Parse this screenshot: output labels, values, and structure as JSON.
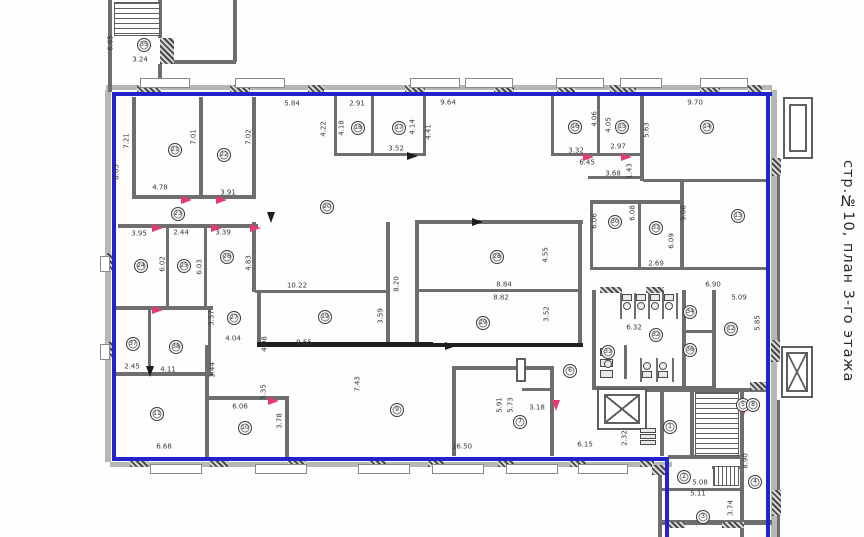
{
  "title": "стр.№10, план 3-го этажа",
  "colors": {
    "boundary": "#2323cd",
    "wall": "#6e6e6e",
    "dark_wall": "#1f1f1f",
    "door_red": "#e23a74",
    "label": "#3a3a3a"
  },
  "plan": {
    "bands": [
      [
        106,
        85,
        666,
        5
      ],
      [
        105,
        90,
        6,
        372
      ],
      [
        110,
        462,
        562,
        5
      ],
      [
        771,
        90,
        6,
        447
      ]
    ],
    "walls": [
      [
        108,
        0,
        4,
        92
      ],
      [
        158,
        0,
        4,
        38
      ],
      [
        158,
        64,
        4,
        24
      ],
      [
        233,
        0,
        4,
        62
      ],
      [
        174,
        60,
        62,
        4
      ],
      [
        132,
        97,
        4,
        100
      ],
      [
        199,
        97,
        4,
        100
      ],
      [
        252,
        97,
        4,
        100
      ],
      [
        132,
        195,
        124,
        4
      ],
      [
        334,
        95,
        3,
        60
      ],
      [
        371,
        95,
        3,
        60
      ],
      [
        423,
        95,
        3,
        60
      ],
      [
        334,
        153,
        92,
        3
      ],
      [
        551,
        95,
        3,
        60
      ],
      [
        597,
        95,
        3,
        60
      ],
      [
        640,
        95,
        4,
        86
      ],
      [
        551,
        153,
        92,
        3
      ],
      [
        588,
        176,
        54,
        3
      ],
      [
        590,
        200,
        92,
        4
      ],
      [
        643,
        179,
        126,
        3
      ],
      [
        680,
        182,
        4,
        88
      ],
      [
        590,
        203,
        3,
        66
      ],
      [
        638,
        203,
        3,
        66
      ],
      [
        590,
        267,
        180,
        3
      ],
      [
        118,
        224,
        140,
        4
      ],
      [
        166,
        228,
        3,
        80
      ],
      [
        204,
        228,
        3,
        80
      ],
      [
        252,
        222,
        4,
        70
      ],
      [
        115,
        306,
        98,
        4
      ],
      [
        255,
        290,
        134,
        3
      ],
      [
        386,
        222,
        4,
        124
      ],
      [
        415,
        220,
        168,
        4
      ],
      [
        415,
        224,
        4,
        120
      ],
      [
        578,
        220,
        4,
        124
      ],
      [
        415,
        289,
        164,
        3
      ],
      [
        148,
        310,
        3,
        62
      ],
      [
        208,
        310,
        3,
        62
      ],
      [
        115,
        372,
        98,
        4
      ],
      [
        205,
        345,
        4,
        114
      ],
      [
        257,
        290,
        4,
        54
      ],
      [
        285,
        396,
        4,
        62
      ],
      [
        208,
        396,
        80,
        4
      ],
      [
        452,
        366,
        4,
        90
      ],
      [
        452,
        366,
        102,
        4
      ],
      [
        550,
        366,
        4,
        90
      ],
      [
        522,
        388,
        32,
        3
      ],
      [
        592,
        290,
        4,
        98
      ],
      [
        682,
        290,
        4,
        98
      ],
      [
        712,
        290,
        4,
        98
      ],
      [
        592,
        386,
        122,
        4
      ],
      [
        682,
        330,
        30,
        3
      ],
      [
        645,
        388,
        124,
        4
      ],
      [
        660,
        392,
        4,
        64
      ],
      [
        690,
        392,
        4,
        64
      ],
      [
        740,
        392,
        4,
        78
      ],
      [
        668,
        455,
        74,
        4
      ],
      [
        658,
        465,
        4,
        72
      ],
      [
        660,
        488,
        80,
        3
      ],
      [
        712,
        466,
        28,
        3
      ],
      [
        740,
        468,
        4,
        69
      ],
      [
        658,
        520,
        114,
        5
      ],
      [
        777,
        158,
        3,
        190
      ],
      [
        777,
        400,
        3,
        137
      ],
      [
        620,
        293,
        2,
        26
      ],
      [
        634,
        293,
        2,
        26
      ],
      [
        648,
        293,
        2,
        26
      ],
      [
        662,
        293,
        2,
        26
      ],
      [
        676,
        293,
        2,
        26
      ],
      [
        640,
        358,
        2,
        24
      ],
      [
        656,
        358,
        2,
        24
      ],
      [
        672,
        358,
        2,
        24
      ],
      [
        624,
        345,
        3,
        34
      ],
      [
        135,
        2,
        2,
        34
      ],
      [
        715,
        392,
        2,
        64
      ],
      [
        257,
        342,
        176,
        5,
        1
      ],
      [
        415,
        343,
        168,
        4,
        1
      ]
    ],
    "blue": [
      [
        112,
        92,
        660,
        4
      ],
      [
        112,
        92,
        4,
        369
      ],
      [
        112,
        457,
        557,
        4
      ],
      [
        665,
        457,
        4,
        80
      ],
      [
        766,
        92,
        4,
        445
      ]
    ],
    "hatch": [
      [
        137,
        85,
        24,
        8
      ],
      [
        230,
        85,
        20,
        8
      ],
      [
        308,
        85,
        16,
        8
      ],
      [
        405,
        85,
        20,
        8
      ],
      [
        494,
        85,
        20,
        8
      ],
      [
        557,
        85,
        18,
        8
      ],
      [
        610,
        85,
        26,
        8
      ],
      [
        700,
        85,
        20,
        8
      ],
      [
        748,
        85,
        14,
        8
      ],
      [
        130,
        459,
        18,
        8
      ],
      [
        210,
        459,
        18,
        8
      ],
      [
        288,
        459,
        18,
        8
      ],
      [
        370,
        459,
        16,
        8
      ],
      [
        428,
        459,
        16,
        8
      ],
      [
        498,
        459,
        16,
        8
      ],
      [
        570,
        459,
        16,
        8
      ],
      [
        640,
        459,
        14,
        8
      ],
      [
        107,
        253,
        8,
        18
      ],
      [
        107,
        342,
        8,
        16
      ],
      [
        772,
        158,
        9,
        18
      ],
      [
        771,
        340,
        9,
        22
      ],
      [
        772,
        490,
        9,
        26
      ],
      [
        750,
        382,
        16,
        8
      ],
      [
        652,
        465,
        14,
        10
      ],
      [
        160,
        38,
        14,
        26
      ],
      [
        600,
        287,
        22,
        6
      ],
      [
        646,
        287,
        18,
        6
      ],
      [
        665,
        522,
        20,
        6
      ],
      [
        722,
        522,
        22,
        6
      ]
    ],
    "sills": [
      [
        140,
        78,
        50,
        10
      ],
      [
        235,
        78,
        50,
        10
      ],
      [
        410,
        78,
        50,
        10
      ],
      [
        465,
        78,
        48,
        10
      ],
      [
        556,
        78,
        48,
        10
      ],
      [
        620,
        78,
        42,
        10
      ],
      [
        700,
        78,
        48,
        10
      ],
      [
        150,
        464,
        52,
        10
      ],
      [
        255,
        464,
        52,
        10
      ],
      [
        358,
        464,
        52,
        10
      ],
      [
        432,
        464,
        52,
        10
      ],
      [
        506,
        464,
        52,
        10
      ],
      [
        578,
        464,
        50,
        10
      ],
      [
        100,
        256,
        10,
        16
      ],
      [
        100,
        344,
        10,
        16
      ]
    ],
    "orects": [
      [
        597,
        388,
        50,
        42
      ],
      [
        781,
        346,
        32,
        52
      ],
      [
        783,
        97,
        30,
        62
      ],
      [
        789,
        104,
        18,
        48
      ],
      [
        516,
        358,
        10,
        24
      ]
    ],
    "stairs": [
      [
        114,
        2,
        46,
        34,
        "h"
      ],
      [
        695,
        392,
        44,
        64,
        "h"
      ],
      [
        713,
        466,
        26,
        20,
        "v"
      ]
    ],
    "xboxes": [
      [
        604,
        394,
        36,
        30
      ],
      [
        786,
        352,
        22,
        40
      ]
    ],
    "doors": [
      [
        152,
        224,
        "h",
        "r"
      ],
      [
        211,
        224,
        "h",
        "r"
      ],
      [
        250,
        224,
        "h",
        "r"
      ],
      [
        181,
        196,
        "h",
        "r"
      ],
      [
        216,
        196,
        "h",
        "r"
      ],
      [
        583,
        153,
        "h",
        "r"
      ],
      [
        621,
        153,
        "h",
        "r"
      ],
      [
        152,
        306,
        "h",
        "r"
      ],
      [
        268,
        397,
        "h",
        "r"
      ],
      [
        552,
        400,
        "v",
        "r"
      ],
      [
        740,
        404,
        "v",
        "r"
      ],
      [
        407,
        152,
        "h",
        "k"
      ],
      [
        472,
        218,
        "h",
        "k"
      ],
      [
        445,
        342,
        "h",
        "k"
      ],
      [
        146,
        366,
        "v",
        "k"
      ],
      [
        267,
        212,
        "v",
        "k"
      ]
    ],
    "frects": [
      [
        622,
        294,
        10,
        7
      ],
      [
        636,
        294,
        10,
        7
      ],
      [
        650,
        294,
        10,
        7
      ],
      [
        664,
        294,
        10,
        7
      ],
      [
        642,
        371,
        10,
        7
      ],
      [
        658,
        371,
        10,
        7
      ],
      [
        600,
        348,
        13,
        8
      ],
      [
        600,
        359,
        13,
        8
      ],
      [
        600,
        370,
        13,
        8
      ],
      [
        640,
        428,
        16,
        5
      ],
      [
        640,
        434,
        16,
        5
      ],
      [
        640,
        440,
        16,
        5
      ]
    ],
    "fcircles": [
      [
        627,
        306
      ],
      [
        641,
        306
      ],
      [
        655,
        306
      ],
      [
        669,
        306
      ],
      [
        647,
        366
      ],
      [
        663,
        366
      ],
      [
        608,
        353
      ],
      [
        608,
        364
      ]
    ],
    "circles": [
      [
        35,
        144,
        45
      ],
      [
        21,
        175,
        150
      ],
      [
        22,
        224,
        155
      ],
      [
        23,
        178,
        214
      ],
      [
        20,
        327,
        207
      ],
      [
        18,
        358,
        128
      ],
      [
        17,
        399,
        128
      ],
      [
        16,
        575,
        127
      ],
      [
        15,
        622,
        127
      ],
      [
        14,
        707,
        127
      ],
      [
        24,
        141,
        266
      ],
      [
        25,
        184,
        266
      ],
      [
        26,
        227,
        257
      ],
      [
        27,
        234,
        318
      ],
      [
        19,
        325,
        317
      ],
      [
        28,
        497,
        257
      ],
      [
        29,
        483,
        323
      ],
      [
        30,
        615,
        222
      ],
      [
        31,
        656,
        228
      ],
      [
        13,
        738,
        216
      ],
      [
        12,
        731,
        329
      ],
      [
        32,
        656,
        335
      ],
      [
        33,
        608,
        352
      ],
      [
        34,
        690,
        312
      ],
      [
        36,
        690,
        350
      ],
      [
        37,
        133,
        344
      ],
      [
        38,
        176,
        347
      ],
      [
        11,
        157,
        414
      ],
      [
        10,
        245,
        428
      ],
      [
        9,
        397,
        410
      ],
      [
        7,
        520,
        422
      ],
      [
        6,
        570,
        371
      ],
      [
        1,
        670,
        427
      ],
      [
        2,
        684,
        477
      ],
      [
        3,
        703,
        517
      ],
      [
        4,
        755,
        482
      ],
      [
        5,
        743,
        405
      ],
      [
        8,
        753,
        405
      ]
    ],
    "labels": [
      [
        "3.24",
        140,
        60,
        0
      ],
      [
        "6.65",
        111,
        43,
        1
      ],
      [
        "8.65",
        117,
        172,
        1
      ],
      [
        "7.21",
        127,
        141,
        1
      ],
      [
        "7.01",
        194,
        137,
        1
      ],
      [
        "7.02",
        249,
        137,
        1
      ],
      [
        "4.78",
        160,
        188,
        0
      ],
      [
        "3.91",
        228,
        193,
        0
      ],
      [
        "5.84",
        292,
        104,
        0
      ],
      [
        "2.91",
        357,
        104,
        0
      ],
      [
        "9.64",
        448,
        103,
        0
      ],
      [
        "4.22",
        324,
        129,
        1
      ],
      [
        "4.18",
        342,
        128,
        1
      ],
      [
        "4.14",
        413,
        127,
        1
      ],
      [
        "4.41",
        429,
        132,
        1
      ],
      [
        "3.52",
        396,
        149,
        0
      ],
      [
        "4.06",
        595,
        119,
        1
      ],
      [
        "4.05",
        609,
        125,
        1
      ],
      [
        "5.63",
        647,
        130,
        1
      ],
      [
        "9.70",
        695,
        103,
        0
      ],
      [
        "3.32",
        576,
        151,
        0
      ],
      [
        "2.97",
        618,
        147,
        0
      ],
      [
        "6.45",
        587,
        163,
        0
      ],
      [
        "1.43",
        630,
        171,
        1
      ],
      [
        "3.68",
        613,
        174,
        0
      ],
      [
        "3.95",
        139,
        234,
        0
      ],
      [
        "2.44",
        181,
        233,
        0
      ],
      [
        "3.39",
        223,
        233,
        0
      ],
      [
        "6.02",
        163,
        264,
        1
      ],
      [
        "6.03",
        200,
        267,
        1
      ],
      [
        "4.83",
        249,
        263,
        1
      ],
      [
        "10.22",
        297,
        286,
        0
      ],
      [
        "8.84",
        504,
        285,
        0
      ],
      [
        "8.82",
        501,
        298,
        0
      ],
      [
        "4.55",
        546,
        255,
        1
      ],
      [
        "3.52",
        547,
        314,
        1
      ],
      [
        "8.20",
        397,
        284,
        1
      ],
      [
        "3.59",
        381,
        316,
        1
      ],
      [
        "3.57",
        212,
        318,
        1
      ],
      [
        "4.04",
        233,
        339,
        0
      ],
      [
        "9.55",
        304,
        343,
        0
      ],
      [
        "6.06",
        595,
        221,
        1
      ],
      [
        "6.08",
        633,
        213,
        1
      ],
      [
        "6.09",
        672,
        241,
        1
      ],
      [
        "9.06",
        684,
        213,
        1
      ],
      [
        "2.69",
        656,
        264,
        0
      ],
      [
        "6.90",
        713,
        285,
        0
      ],
      [
        "5.09",
        739,
        298,
        0
      ],
      [
        "5.85",
        758,
        323,
        1
      ],
      [
        "6.32",
        634,
        328,
        0
      ],
      [
        "2.45",
        132,
        367,
        0
      ],
      [
        "4.11",
        168,
        370,
        0
      ],
      [
        "3.44",
        213,
        370,
        1
      ],
      [
        "4.08",
        265,
        344,
        1
      ],
      [
        "6.68",
        164,
        447,
        0
      ],
      [
        "5.35",
        264,
        392,
        1
      ],
      [
        "6.06",
        240,
        407,
        0
      ],
      [
        "3.78",
        280,
        421,
        1
      ],
      [
        "7.43",
        358,
        384,
        1
      ],
      [
        "16.50",
        462,
        447,
        0
      ],
      [
        "5.91",
        500,
        405,
        1
      ],
      [
        "5.73",
        511,
        405,
        1
      ],
      [
        "3.18",
        537,
        408,
        0
      ],
      [
        "6.15",
        585,
        445,
        0
      ],
      [
        "2.32",
        625,
        438,
        1
      ],
      [
        "8.90",
        746,
        461,
        1
      ],
      [
        "5.08",
        700,
        483,
        0
      ],
      [
        "5.11",
        698,
        494,
        0
      ],
      [
        "3.74",
        731,
        508,
        1
      ]
    ]
  }
}
